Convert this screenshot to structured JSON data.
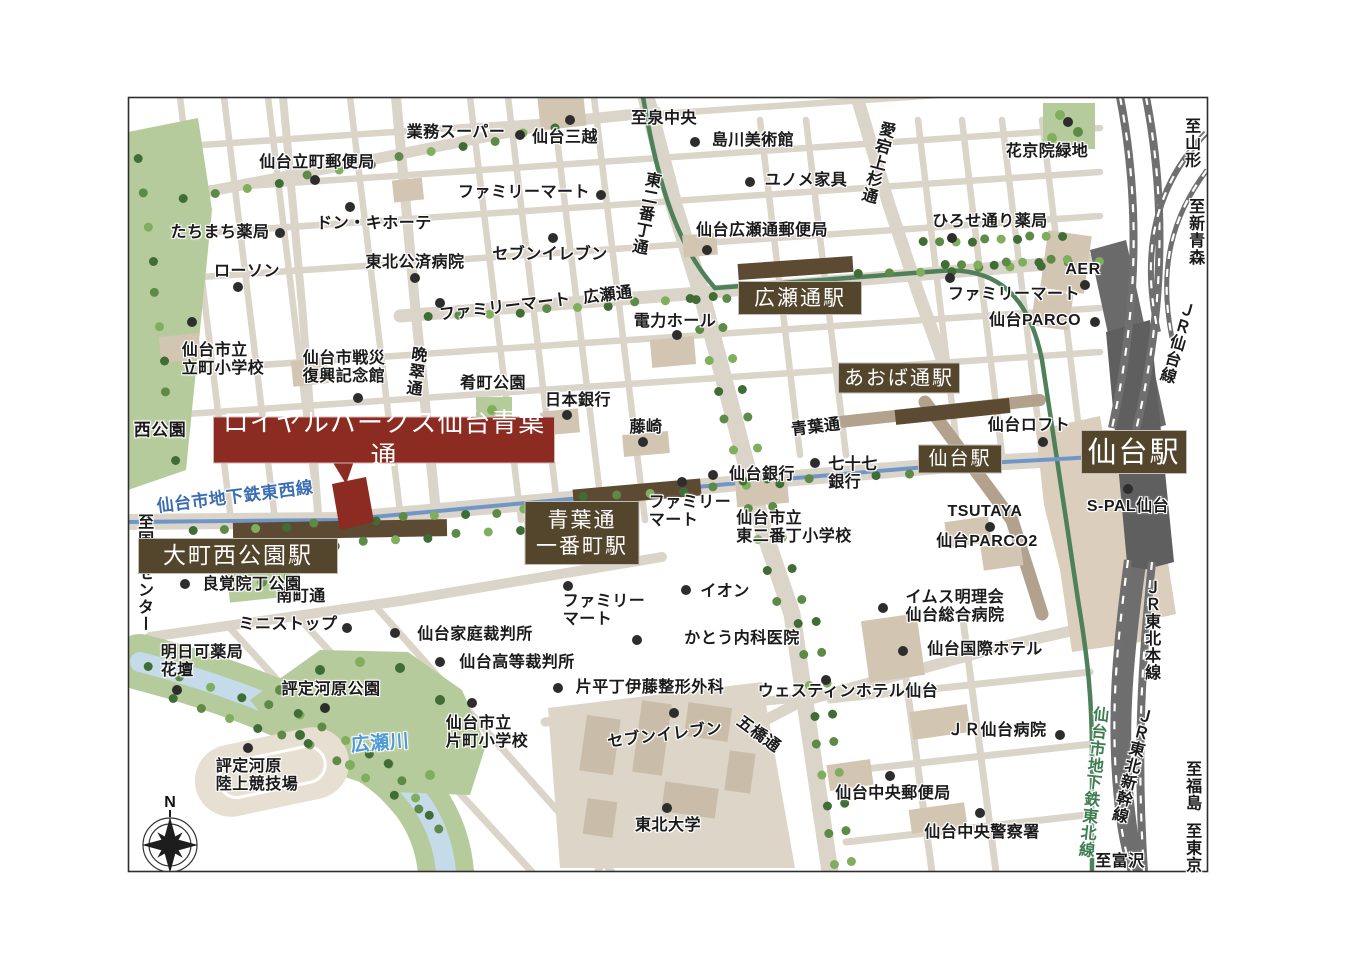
{
  "map": {
    "property_name": "ロイヤルパークス仙台青葉通",
    "compass": {
      "label": "N"
    },
    "colors": {
      "station_box": "#54462c",
      "property_box": "#8c2b22",
      "road": "#dbd4c9",
      "road_brown": "#b2a18c",
      "building": "#d2c5b2",
      "park": "#b6cb9b",
      "river": "#c5dbea",
      "river_text": "#4d9bd4",
      "subway_tozai": "#7096c8",
      "subway_tozai_text": "#3a6db3",
      "subway_namboku": "#4e8159",
      "subway_namboku_text": "#3e7d52",
      "rail": "#6f6f6f",
      "ink": "#1a1a1a"
    },
    "boxes": [
      {
        "t": "広瀬通駅",
        "x": 800,
        "y": 298,
        "w": 122,
        "h": 32,
        "s": 21,
        "n": "station-hirosedori"
      },
      {
        "t": "あおば通駅",
        "x": 899,
        "y": 378,
        "w": 120,
        "h": 29,
        "s": 20,
        "n": "station-aobadori"
      },
      {
        "t": "仙台駅",
        "x": 960,
        "y": 459,
        "w": 82,
        "h": 27,
        "s": 19,
        "n": "station-sendai-subway"
      },
      {
        "t": "仙台駅",
        "x": 1134,
        "y": 452,
        "w": 104,
        "h": 42,
        "s": 29,
        "n": "station-sendai-jr"
      },
      {
        "t": "大町西公園駅",
        "x": 238,
        "y": 556,
        "w": 198,
        "h": 34,
        "s": 23,
        "n": "station-omachi-nishikoen"
      },
      {
        "t": "青葉通\n一番町駅",
        "x": 582,
        "y": 533,
        "w": 113,
        "h": 62,
        "s": 21,
        "n": "station-aobadori-ichibancho"
      },
      {
        "t": "ロイヤルパークス仙台青葉通",
        "x": 384,
        "y": 440,
        "w": 340,
        "h": 45,
        "s": 26,
        "bg": "property_box",
        "n": "property-callout"
      }
    ],
    "labels": [
      {
        "t": "業務スーパー",
        "x": 456,
        "y": 133
      },
      {
        "t": "仙台三越",
        "x": 565,
        "y": 138
      },
      {
        "t": "仙台立町郵便局",
        "x": 317,
        "y": 163
      },
      {
        "t": "ファミリーマート",
        "x": 524,
        "y": 193
      },
      {
        "t": "ドン・キホーテ",
        "x": 374,
        "y": 224
      },
      {
        "t": "たちまち薬局",
        "x": 220,
        "y": 233
      },
      {
        "t": "東北公済病院",
        "x": 415,
        "y": 263
      },
      {
        "t": "セブンイレブン",
        "x": 550,
        "y": 255
      },
      {
        "t": "ローソン",
        "x": 247,
        "y": 272
      },
      {
        "t": "ファミリーマート",
        "x": 505,
        "y": 308,
        "r": -7
      },
      {
        "t": "広瀬通",
        "x": 608,
        "y": 296,
        "r": -7
      },
      {
        "t": "至泉中央",
        "x": 664,
        "y": 119
      },
      {
        "t": "島川美術館",
        "x": 753,
        "y": 141
      },
      {
        "t": "ユノメ家具",
        "x": 806,
        "y": 181
      },
      {
        "t": "仙台広瀬通郵便局",
        "x": 762,
        "y": 231
      },
      {
        "t": "愛宕上杉通",
        "x": 876,
        "y": 162,
        "v": 1,
        "r": 15
      },
      {
        "t": "東二番丁通",
        "x": 644,
        "y": 213,
        "v": 1,
        "r": 11
      },
      {
        "t": "花京院緑地",
        "x": 1047,
        "y": 152
      },
      {
        "t": "ひろせ通り薬局",
        "x": 990,
        "y": 222
      },
      {
        "t": "AER",
        "x": 1083,
        "y": 270
      },
      {
        "t": "ファミリーマート",
        "x": 1014,
        "y": 295
      },
      {
        "t": "仙台PARCO",
        "x": 1035,
        "y": 321
      },
      {
        "t": "至山形",
        "x": 1190,
        "y": 143,
        "v": 1
      },
      {
        "t": "至新青森",
        "x": 1194,
        "y": 232,
        "v": 1
      },
      {
        "t": "ＪＲ仙台線",
        "x": 1175,
        "y": 342,
        "v": 1,
        "r": 16
      },
      {
        "t": "仙台市立\n立町小学校",
        "x": 223,
        "y": 360,
        "a": "left"
      },
      {
        "t": "仙台市戦災\n復興記念館",
        "x": 344,
        "y": 368,
        "a": "left"
      },
      {
        "t": "晩翠通",
        "x": 414,
        "y": 371,
        "v": 1,
        "r": 8
      },
      {
        "t": "肴町公園",
        "x": 493,
        "y": 384
      },
      {
        "t": "日本銀行",
        "x": 578,
        "y": 401
      },
      {
        "t": "西公園",
        "x": 160,
        "y": 430,
        "s": 17
      },
      {
        "t": "仙台市地下鉄東西線",
        "x": 235,
        "y": 497,
        "r": -7,
        "c": "subway_tozai_text",
        "s": 17,
        "b": 1
      },
      {
        "t": "電力ホール",
        "x": 675,
        "y": 322
      },
      {
        "t": "藤崎",
        "x": 646,
        "y": 428
      },
      {
        "t": "青葉通",
        "x": 816,
        "y": 428,
        "r": -7
      },
      {
        "t": "仙台銀行",
        "x": 762,
        "y": 475
      },
      {
        "t": "七十七\n銀行",
        "x": 853,
        "y": 474,
        "a": "left"
      },
      {
        "t": "ファミリー\nマート",
        "x": 690,
        "y": 512,
        "a": "left"
      },
      {
        "t": "仙台市立\n東二番丁小学校",
        "x": 794,
        "y": 528,
        "a": "left"
      },
      {
        "t": "仙台ロフト",
        "x": 1029,
        "y": 426
      },
      {
        "t": "TSUTAYA",
        "x": 985,
        "y": 512
      },
      {
        "t": "仙台PARCO2",
        "x": 987,
        "y": 542
      },
      {
        "t": "S-PAL仙台",
        "x": 1128,
        "y": 507
      },
      {
        "t": "至国際センター",
        "x": 143,
        "y": 573,
        "v": 1
      },
      {
        "t": "南町通",
        "x": 301,
        "y": 597
      },
      {
        "t": "ミニストップ",
        "x": 288,
        "y": 625
      },
      {
        "t": "明日可薬局\n花壇",
        "x": 202,
        "y": 662,
        "a": "left"
      },
      {
        "t": "良覚院丁公園",
        "x": 252,
        "y": 585
      },
      {
        "t": "評定河原公園",
        "x": 331,
        "y": 690
      },
      {
        "t": "仙台家庭裁判所",
        "x": 475,
        "y": 635
      },
      {
        "t": "仙台高等裁判所",
        "x": 517,
        "y": 663
      },
      {
        "t": "ファミリー\nマート",
        "x": 604,
        "y": 611,
        "a": "left"
      },
      {
        "t": "イオン",
        "x": 725,
        "y": 592
      },
      {
        "t": "かとう内科医院",
        "x": 742,
        "y": 639
      },
      {
        "t": "片平丁伊藤整形外科",
        "x": 650,
        "y": 688
      },
      {
        "t": "評定河原\n陸上競技場",
        "x": 257,
        "y": 776,
        "a": "left"
      },
      {
        "t": "広瀬川",
        "x": 380,
        "y": 744,
        "c": "river_text",
        "s": 19,
        "r": -4
      },
      {
        "t": "仙台市立\n片町小学校",
        "x": 487,
        "y": 733,
        "a": "left"
      },
      {
        "t": "セブンイレブン",
        "x": 665,
        "y": 736,
        "r": -7
      },
      {
        "t": "五橋通",
        "x": 758,
        "y": 735,
        "r": 36
      },
      {
        "t": "東北大学",
        "x": 668,
        "y": 826
      },
      {
        "t": "ウェスティンホテル仙台",
        "x": 848,
        "y": 692
      },
      {
        "t": "イムス明理会\n仙台総合病院",
        "x": 955,
        "y": 607,
        "a": "left"
      },
      {
        "t": "仙台国際ホテル",
        "x": 985,
        "y": 650
      },
      {
        "t": "ＪＲ仙台病院",
        "x": 997,
        "y": 731
      },
      {
        "t": "仙台中央郵便局",
        "x": 893,
        "y": 794
      },
      {
        "t": "仙台中央警察署",
        "x": 982,
        "y": 833
      },
      {
        "t": "ＪＲ東北本線",
        "x": 1150,
        "y": 630,
        "v": 1
      },
      {
        "t": "ＪＲ東北新幹線",
        "x": 1130,
        "y": 765,
        "v": 1,
        "r": 14
      },
      {
        "t": "仙台市地下鉄東北線",
        "x": 1091,
        "y": 782,
        "v": 1,
        "r": 6,
        "c": "subway_namboku_text",
        "b": 1
      },
      {
        "t": "至福島",
        "x": 1191,
        "y": 786,
        "v": 1
      },
      {
        "t": "至東京",
        "x": 1191,
        "y": 848,
        "v": 1
      },
      {
        "t": "至富沢",
        "x": 1120,
        "y": 862
      }
    ],
    "dots": [
      [
        520,
        135
      ],
      [
        570,
        120
      ],
      [
        315,
        180
      ],
      [
        601,
        195
      ],
      [
        350,
        207
      ],
      [
        280,
        233
      ],
      [
        415,
        278
      ],
      [
        553,
        238
      ],
      [
        238,
        287
      ],
      [
        440,
        303
      ],
      [
        695,
        142
      ],
      [
        750,
        182
      ],
      [
        707,
        250
      ],
      [
        952,
        238
      ],
      [
        950,
        278
      ],
      [
        1085,
        285
      ],
      [
        1095,
        322
      ],
      [
        1068,
        122
      ],
      [
        192,
        322
      ],
      [
        358,
        398
      ],
      [
        567,
        415
      ],
      [
        677,
        335
      ],
      [
        643,
        442
      ],
      [
        713,
        475
      ],
      [
        815,
        463
      ],
      [
        682,
        482
      ],
      [
        1043,
        442
      ],
      [
        990,
        527
      ],
      [
        1128,
        489
      ],
      [
        185,
        584
      ],
      [
        347,
        628
      ],
      [
        177,
        690
      ],
      [
        325,
        708
      ],
      [
        248,
        748
      ],
      [
        395,
        633
      ],
      [
        440,
        662
      ],
      [
        568,
        586
      ],
      [
        686,
        590
      ],
      [
        637,
        640
      ],
      [
        558,
        688
      ],
      [
        674,
        713
      ],
      [
        472,
        703
      ],
      [
        667,
        808
      ],
      [
        826,
        680
      ],
      [
        883,
        608
      ],
      [
        903,
        651
      ],
      [
        1060,
        735
      ],
      [
        890,
        776
      ],
      [
        980,
        813
      ]
    ]
  }
}
